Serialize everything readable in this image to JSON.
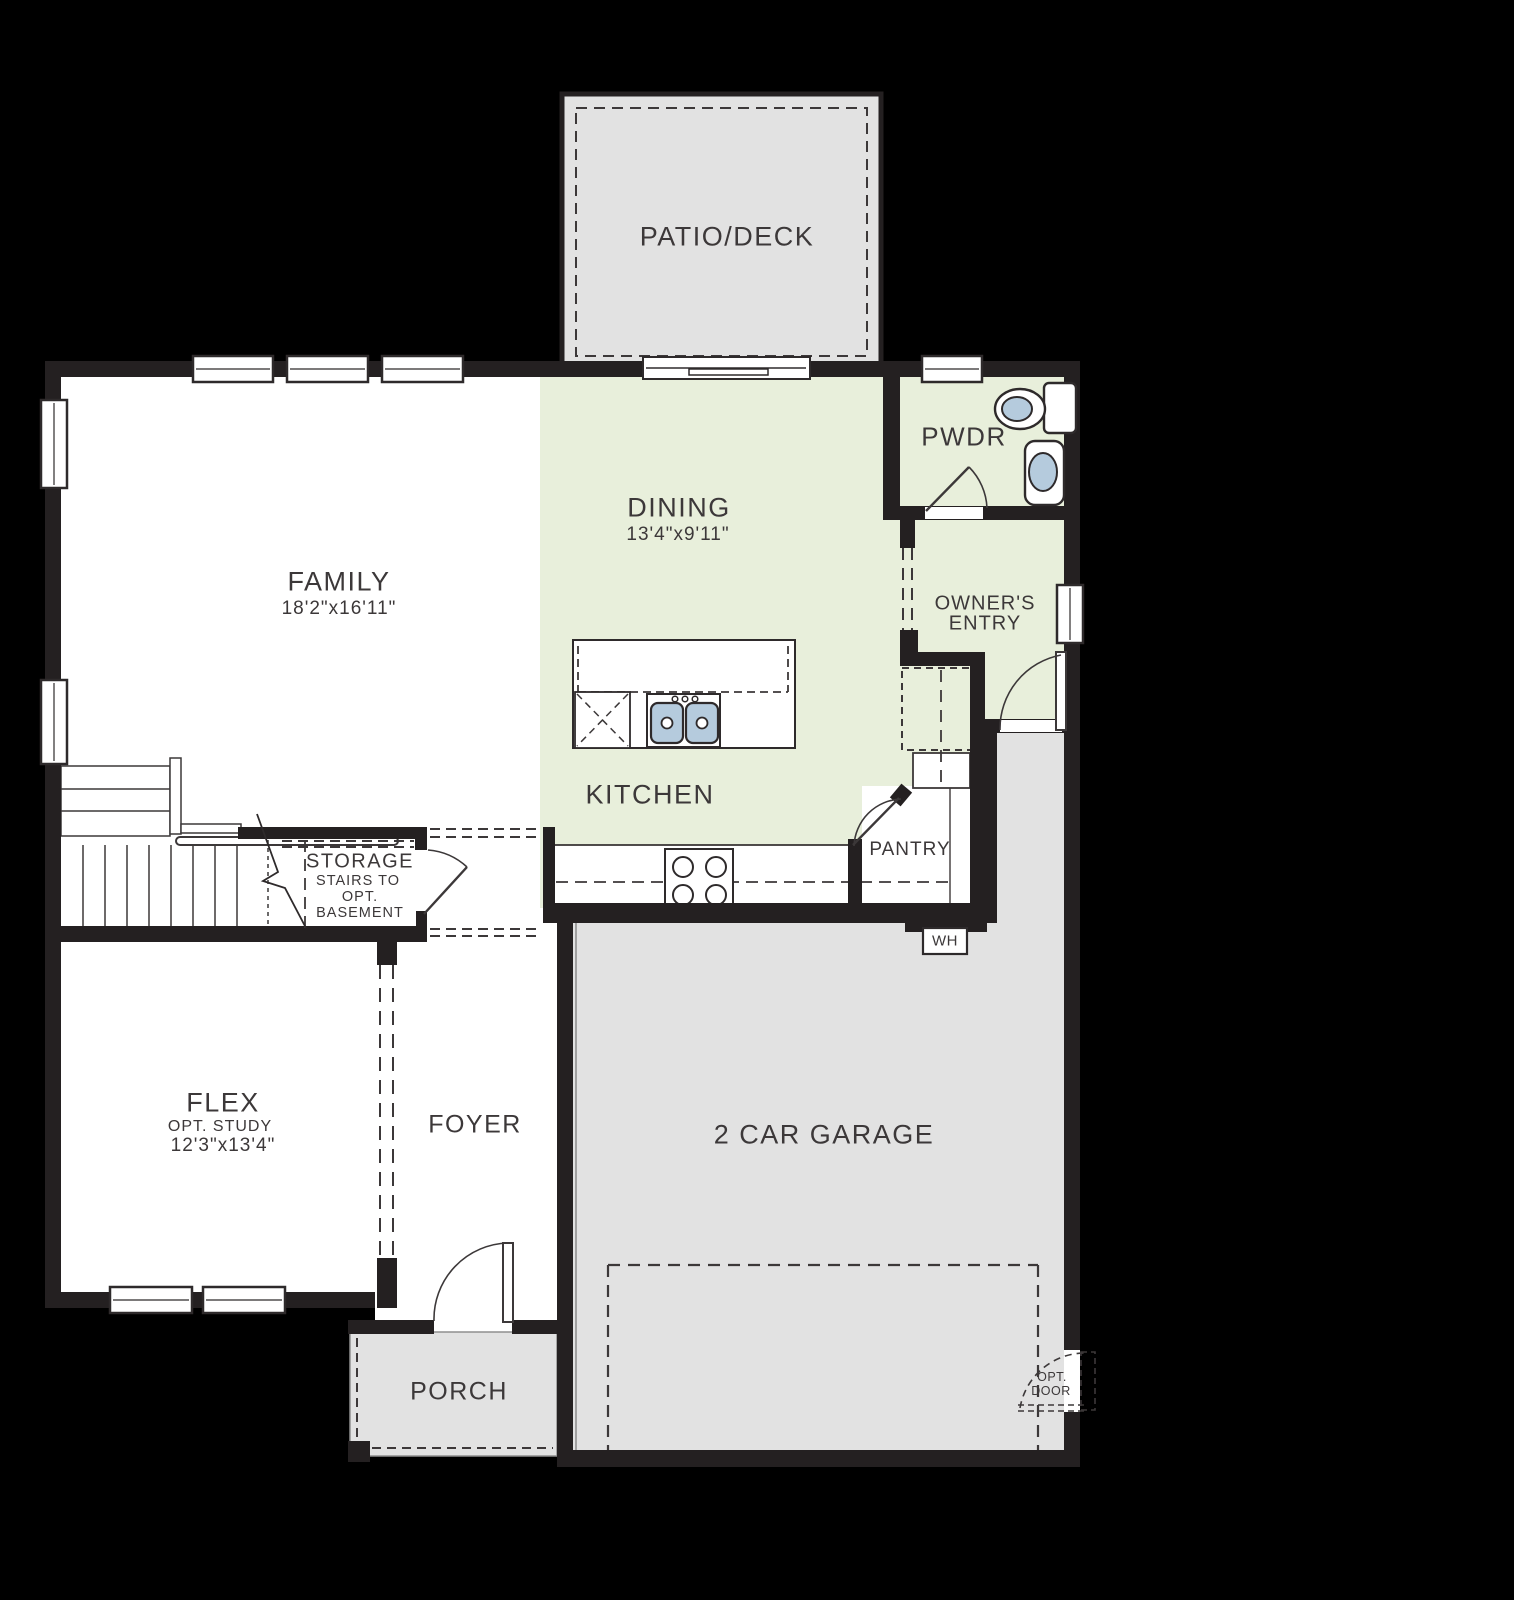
{
  "colors": {
    "background": "#000000",
    "wall": "#242021",
    "room_green": "#e8efdb",
    "area_gray": "#e2e2e2",
    "fixture_blue": "#b5cbdd",
    "label_text": "#3c3839"
  },
  "rooms": {
    "patio": {
      "label": "PATIO/DECK"
    },
    "family": {
      "label": "FAMILY",
      "dims": "18'2\"x16'11\""
    },
    "dining": {
      "label": "DINING",
      "dims": "13'4\"x9'11\""
    },
    "pwdr": {
      "label": "PWDR"
    },
    "owners_entry": {
      "line1": "OWNER'S",
      "line2": "ENTRY"
    },
    "kitchen": {
      "label": "KITCHEN"
    },
    "pantry": {
      "label": "PANTRY"
    },
    "storage": {
      "line1": "STORAGE",
      "line2": "STAIRS TO",
      "line3": "OPT.",
      "line4": "BASEMENT"
    },
    "flex": {
      "label": "FLEX",
      "sub": "OPT. STUDY",
      "dims": "12'3\"x13'4\""
    },
    "foyer": {
      "label": "FOYER"
    },
    "garage": {
      "label": "2 CAR GARAGE"
    },
    "porch": {
      "label": "PORCH"
    },
    "water_heater": {
      "label": "WH"
    },
    "opt_door": {
      "line1": "OPT.",
      "line2": "DOOR"
    }
  }
}
